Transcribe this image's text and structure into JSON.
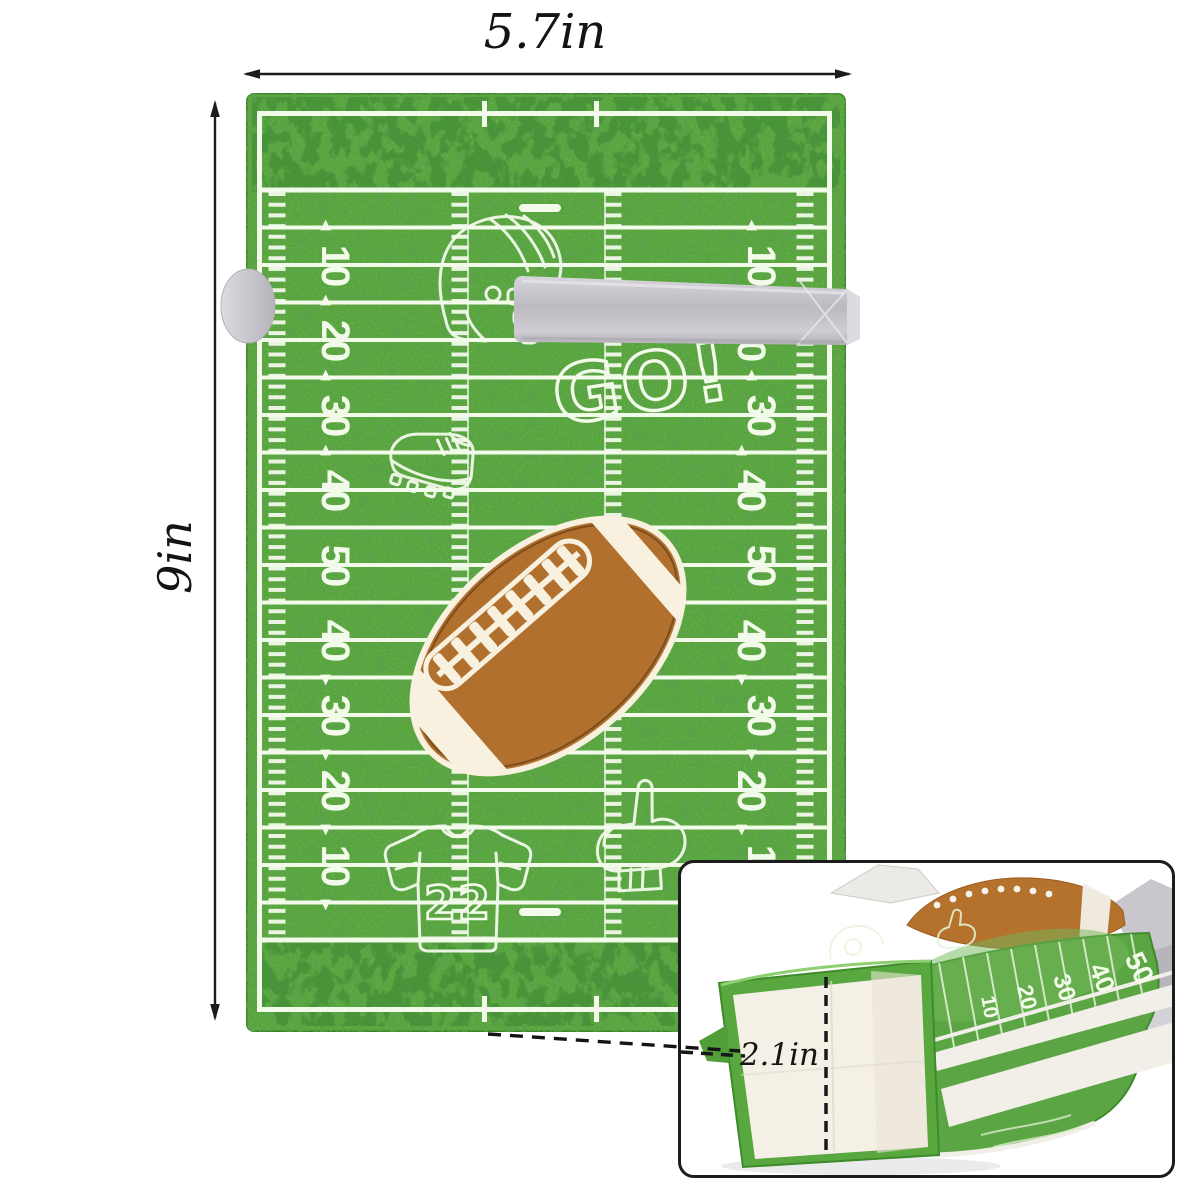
{
  "dimensions": {
    "width": "5.7in",
    "height": "9in",
    "depth": "2.1in"
  },
  "bag": {
    "yard_numbers": [
      "10",
      "20",
      "30",
      "40",
      "50",
      "40",
      "30",
      "20",
      "10"
    ],
    "go_text": "GO!",
    "jersey_number": "22",
    "motifs": [
      "football",
      "football-helmet",
      "cleat",
      "jersey",
      "foam-finger",
      "tissue-slot"
    ]
  },
  "inset": {
    "side_numbers": [
      "10",
      "20",
      "30",
      "40",
      "50"
    ]
  },
  "colors": {
    "field_green": "#58a43d",
    "blotch_green": "#2e7a1e",
    "line_white": "#f2faea",
    "ball_brown": "#b1702d",
    "slot_gray": "#c9c6cd",
    "ink": "#1b1b1b"
  }
}
